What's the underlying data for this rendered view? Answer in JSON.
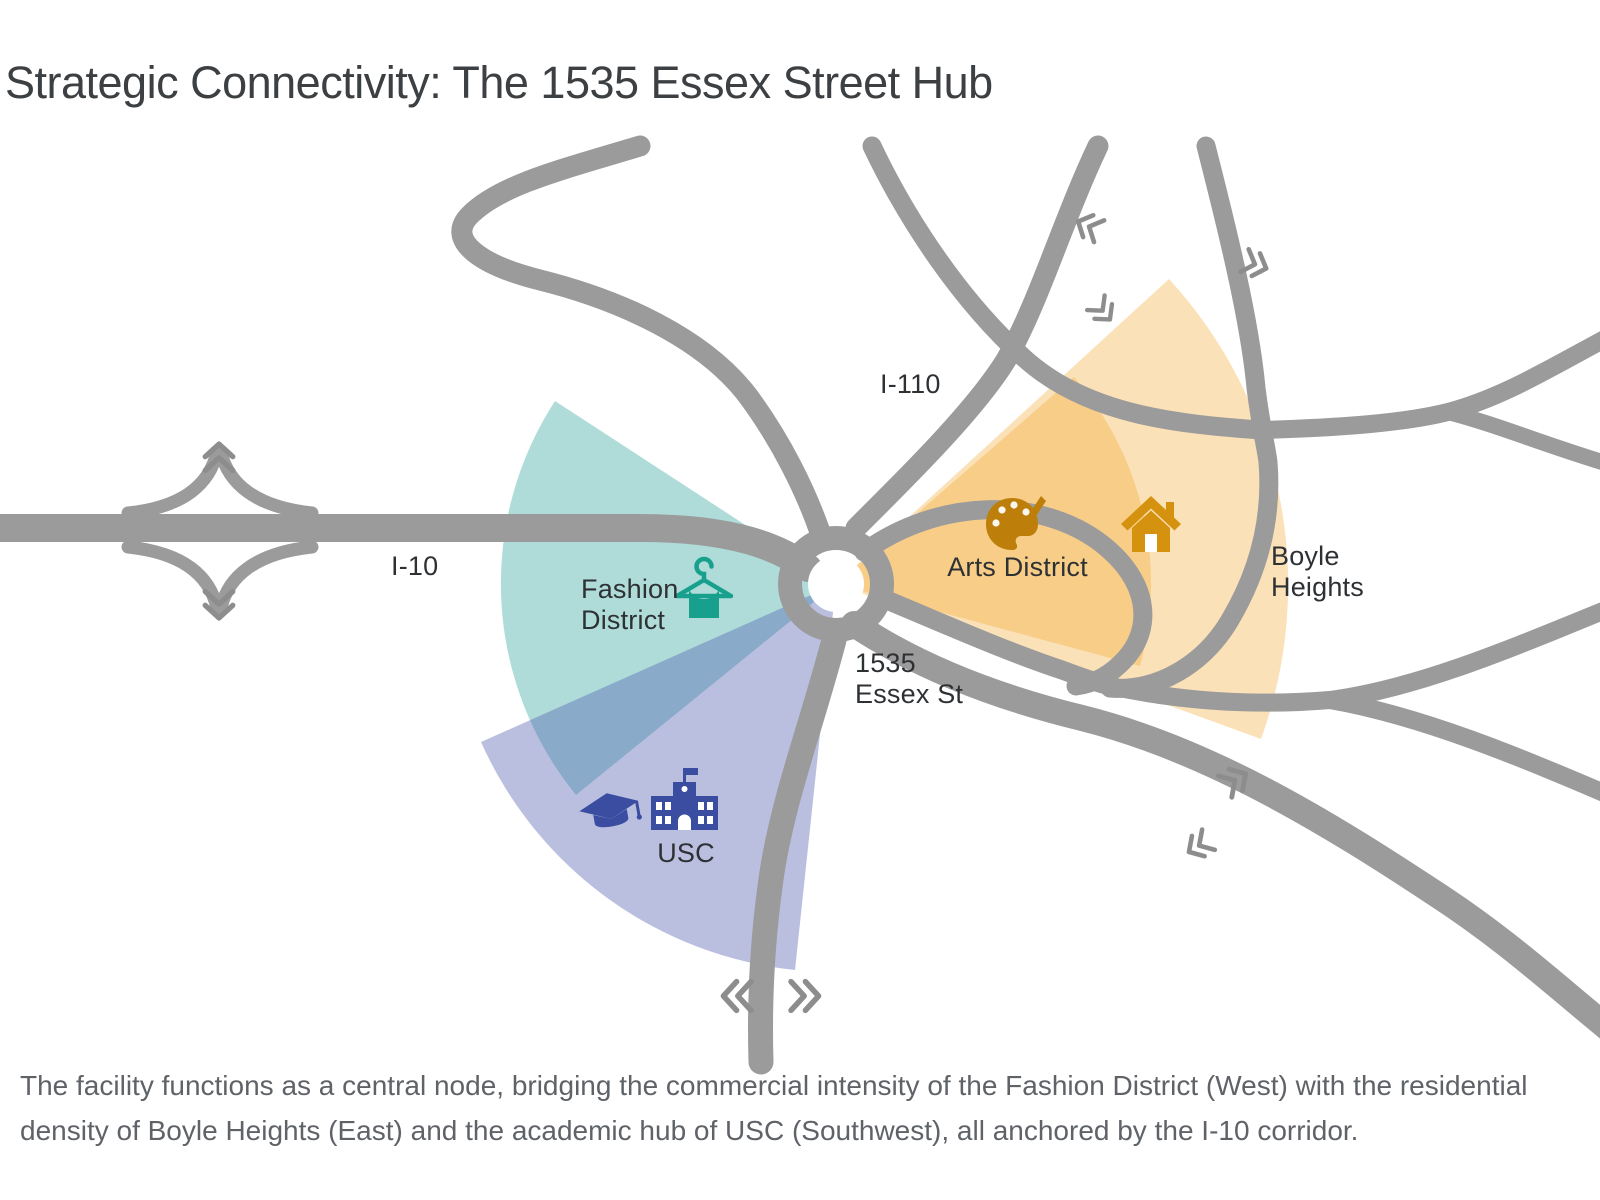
{
  "title": "Strategic Connectivity: The 1535 Essex Street Hub",
  "map": {
    "road_labels": {
      "i110": "I-110",
      "i10": "I-10"
    },
    "hub": {
      "name": "1535 Essex St",
      "label_line1": "1535",
      "label_line2": "Essex St"
    },
    "districts": [
      {
        "id": "fashion",
        "name": "Fashion District",
        "label_line1": "Fashion",
        "label_line2": "District",
        "icon": "hanger-icon",
        "direction": "West",
        "color": "#17a08d"
      },
      {
        "id": "arts",
        "name": "Arts District",
        "label": "Arts District",
        "icon": "palette-icon",
        "direction": "East",
        "color": "#bd7f09"
      },
      {
        "id": "boyle",
        "name": "Boyle Heights",
        "label_line1": "Boyle",
        "label_line2": "Heights",
        "icon": "house-icon",
        "direction": "East",
        "color": "#d4920e"
      },
      {
        "id": "usc",
        "name": "USC",
        "label": "USC",
        "icon": "graduation-cap-icon school-icon",
        "direction": "Southwest",
        "color": "#3b4da0"
      }
    ],
    "colors": {
      "road": "#9b9b9b",
      "chevron": "#8d8d8d",
      "teal_sector": "rgba(26,155,145,0.35)",
      "purple_sector": "rgba(82,96,178,0.40)",
      "orange_sector": "rgba(243,168,50,0.35)",
      "label_text": "#2e3134",
      "title_text": "#3c4043",
      "caption_text": "#5f6368"
    }
  },
  "caption": "The facility functions as a central node, bridging the commercial intensity of the Fashion District (West) with the residential density of Boyle Heights (East) and the academic hub of USC (Southwest), all anchored by the I-10 corridor."
}
